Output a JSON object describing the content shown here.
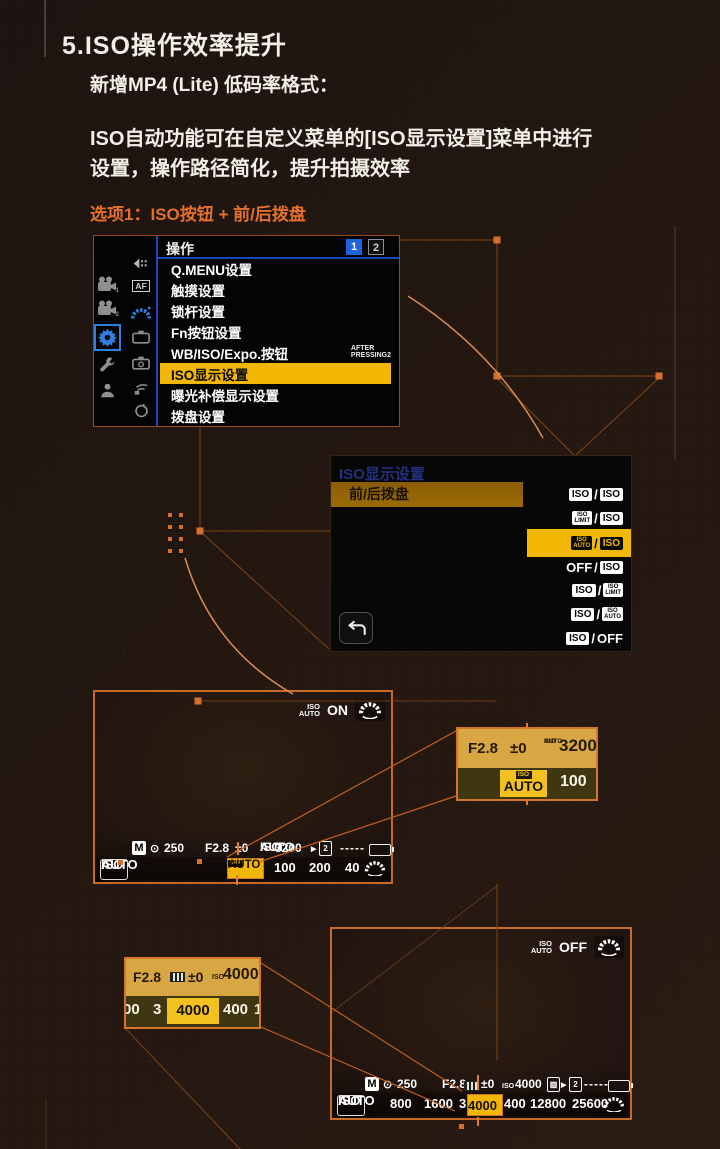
{
  "header": {
    "section_title": "5.ISO操作效率提升",
    "subtitle": "新增MP4 (Lite) 低码率格式：",
    "body_line1": "ISO自动功能可在自定义菜单的[ISO显示设置]菜单中进行",
    "body_line2": "设置，操作路径简化，提升拍摄效率",
    "option_title": "选项1：ISO按钮 + 前/后拨盘"
  },
  "colors": {
    "accent_orange": "#e4702b",
    "highlight_yellow": "#f2b705",
    "menu_blue": "#1e63d8",
    "amber_row": "#9c6b06"
  },
  "menu_screen": {
    "title": "操作",
    "tabs": {
      "tab1": "1",
      "tab2": "2"
    },
    "sidebar_icons_col1": [
      "video-camera-1",
      "video-camera-2",
      "gear",
      "wrench",
      "person"
    ],
    "sidebar_icons_col2": [
      "back-arrow",
      "af-area",
      "front-dial",
      "camera-1",
      "camera-2",
      "wireless",
      "clock"
    ],
    "items": [
      {
        "label": "Q.MENU设置"
      },
      {
        "label": "触摸设置"
      },
      {
        "label": "锁杆设置"
      },
      {
        "label": "Fn按钮设置"
      },
      {
        "label": "WB/ISO/Expo.按钮",
        "note_line1": "AFTER",
        "note_line2": "PRESSING2"
      },
      {
        "label": "ISO显示设置",
        "selected": true
      },
      {
        "label": "曝光补偿显示设置"
      },
      {
        "label": "拨盘设置"
      }
    ]
  },
  "iso_display_screen": {
    "title": "ISO显示设置",
    "item_label": "前/后拨盘",
    "options": [
      {
        "front": "ISO",
        "rear": "ISO"
      },
      {
        "front_top": "ISO",
        "front_bottom": "LIMIT",
        "rear": "ISO"
      },
      {
        "front_top": "ISO",
        "front_bottom": "AUTO",
        "rear": "ISO",
        "selected": true
      },
      {
        "front": "OFF",
        "rear": "ISO"
      },
      {
        "front": "ISO",
        "rear_top": "ISO",
        "rear_bottom": "LIMIT"
      },
      {
        "front": "ISO",
        "rear_top": "ISO",
        "rear_bottom": "AUTO"
      },
      {
        "front": "ISO",
        "rear": "OFF"
      }
    ]
  },
  "liveview_on": {
    "iso_auto_top": "ISO",
    "iso_auto_bottom": "AUTO",
    "state": "ON",
    "status": {
      "mode": "M",
      "shutter": "250",
      "aperture": "F2.8",
      "ev": "±0",
      "iso_small_top": "ISO",
      "iso_small_bottom": "AUTO",
      "iso_value": "3200",
      "card_number": "2",
      "dashes": "-----"
    },
    "iso_badge_top": "ISO",
    "iso_badge_bottom": "AUTO",
    "selector": {
      "tag": "ISO",
      "selected": "AUTO",
      "values": [
        "100",
        "200",
        "40"
      ]
    }
  },
  "inset_on": {
    "aperture": "F2.8",
    "ev": "±0",
    "iso_small_top": "ISO",
    "iso_small_bottom": "AUTO",
    "iso_value": "3200",
    "tag": "ISO",
    "selected": "AUTO",
    "next_value": "100"
  },
  "liveview_off": {
    "iso_auto_top": "ISO",
    "iso_auto_bottom": "AUTO",
    "state": "OFF",
    "status": {
      "mode": "M",
      "shutter": "250",
      "aperture": "F2.8",
      "ev": "±0",
      "iso_prefix": "ISO",
      "iso_value": "4000",
      "card_number": "2",
      "dashes": "-----"
    },
    "iso_badge_top": "ISO",
    "iso_badge_bottom": "AUTO",
    "selector": {
      "values_left": [
        "800",
        "1600",
        "3"
      ],
      "selected": "4000",
      "values_right": [
        "400",
        "12800",
        "25600"
      ]
    }
  },
  "inset_off": {
    "aperture": "F2.8",
    "ev": "±0",
    "iso_prefix": "ISO",
    "iso_value": "4000",
    "strip": {
      "left_cut": "00",
      "v1": "3",
      "selected": "4000",
      "v2": "400",
      "right_cut": "1"
    }
  }
}
